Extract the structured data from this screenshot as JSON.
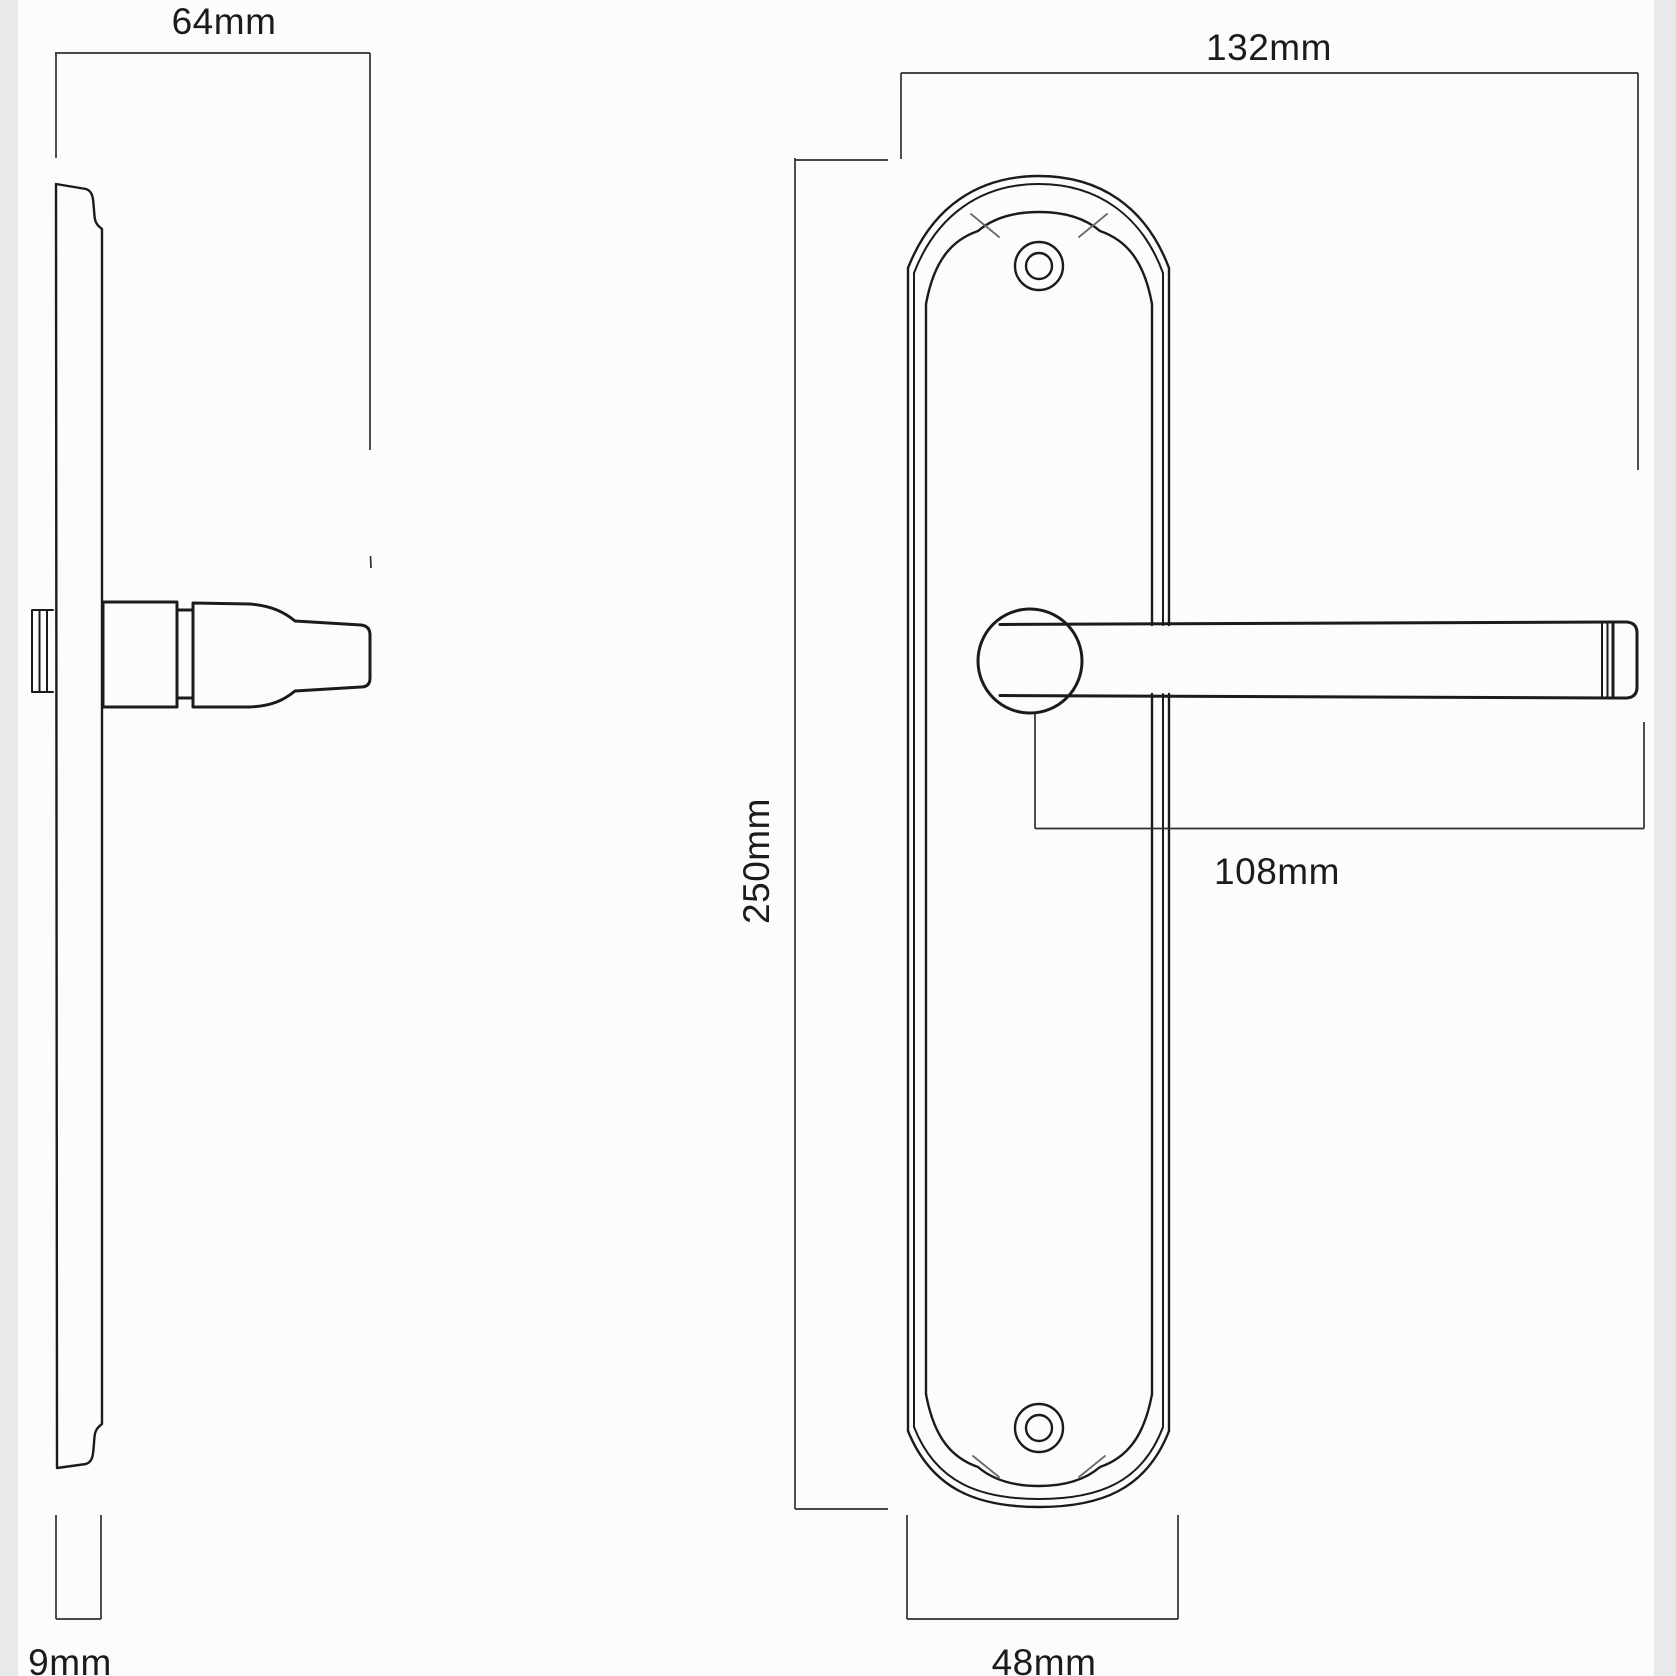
{
  "drawing": {
    "kind": "technical dimension drawing",
    "views": {
      "side": "side-profile-of-handle-on-backplate",
      "front": "front-elevation-of-handle-on-backplate"
    }
  },
  "dimensions": {
    "projection": "64mm",
    "plate_thickness": "9mm",
    "lever_length": "132mm",
    "plate_height": "250mm",
    "handle_reach": "108mm",
    "plate_width": "48mm"
  },
  "colors": {
    "object_line": "#1b1b1b",
    "dim_line": "#2f2f2f",
    "detail_line": "#6a6a6a",
    "text": "#1b1b1b",
    "background": "#fcfcfc",
    "edge_band": "#e8e9ea"
  }
}
